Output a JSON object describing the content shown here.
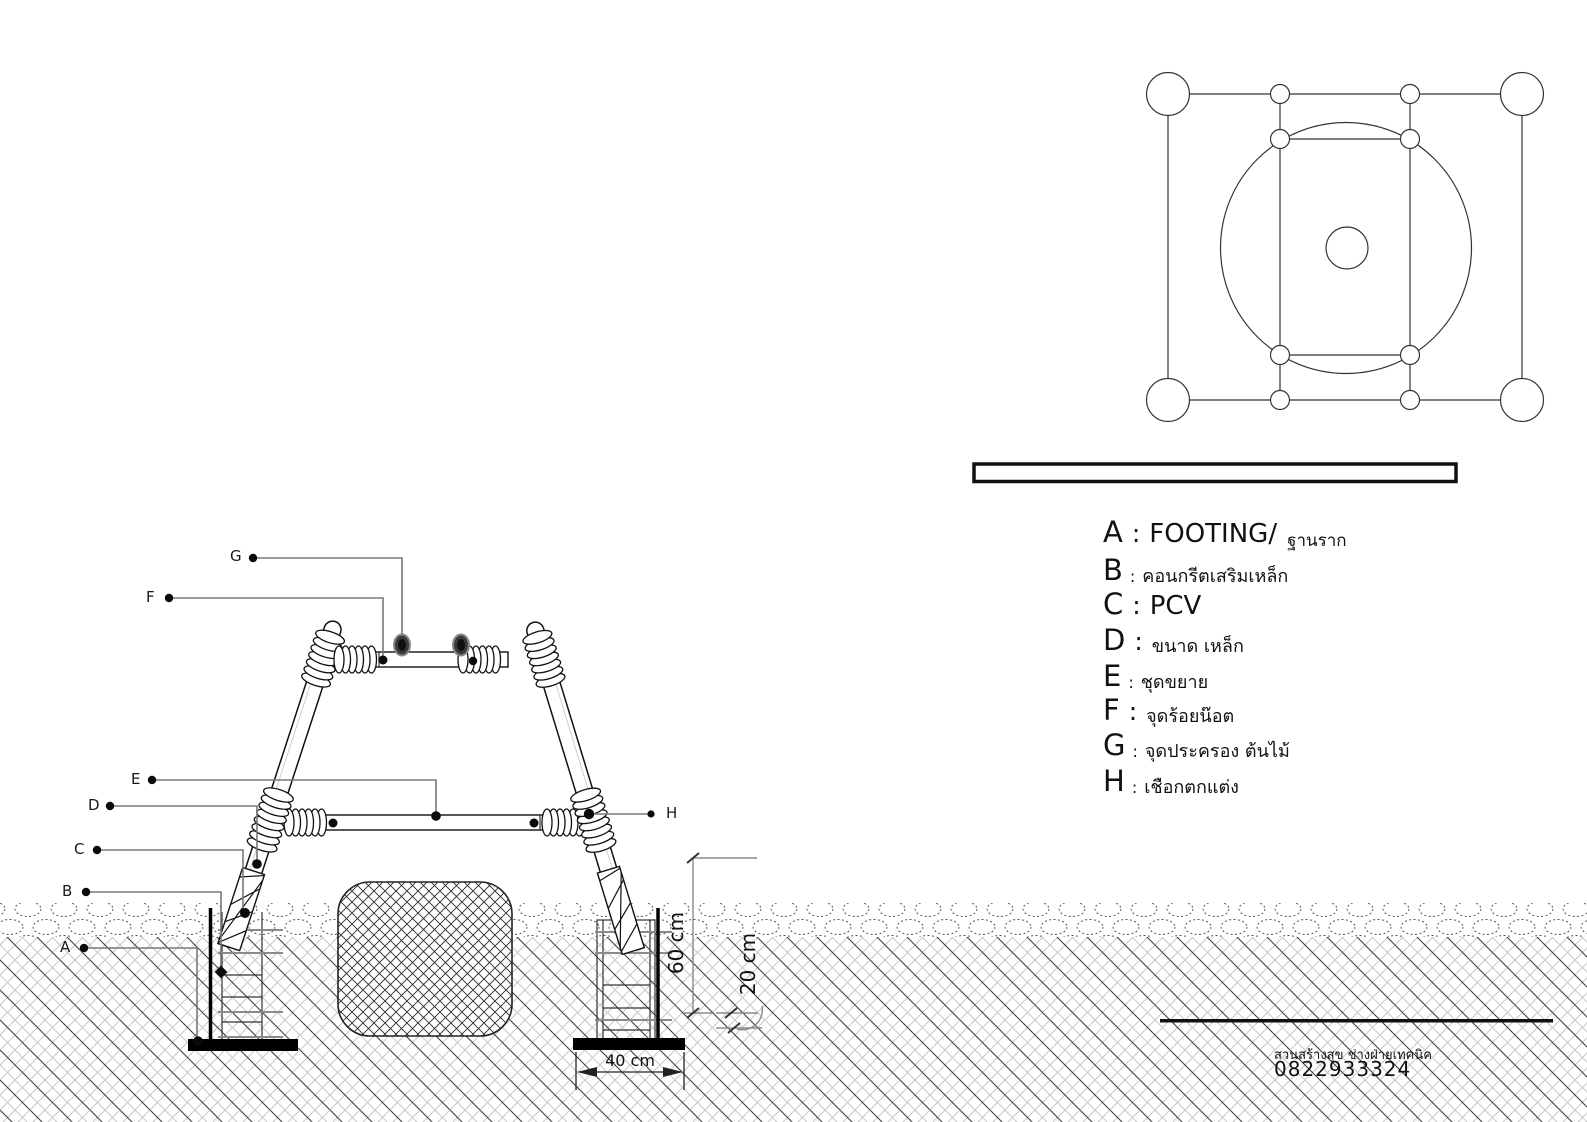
{
  "legend": {
    "items": [
      {
        "letter": "A",
        "sep": ":",
        "label": "FOOTING/",
        "suffix": "ฐานราก"
      },
      {
        "letter": "B",
        "sep": ":",
        "label": "คอนกรีตเสริมเหล็ก",
        "suffix": ""
      },
      {
        "letter": "C",
        "sep": ":",
        "label": "PCV",
        "suffix": ""
      },
      {
        "letter": "D",
        "sep": ":",
        "label": "ขนาด เหล็ก",
        "suffix": ""
      },
      {
        "letter": "E",
        "sep": ":",
        "label": "ชุดขยาย",
        "suffix": ""
      },
      {
        "letter": "F",
        "sep": ":",
        "label": "จุดร้อยน๊อต",
        "suffix": ""
      },
      {
        "letter": "G",
        "sep": ":",
        "label": "จุดประครอง ต้นไม้",
        "suffix": ""
      },
      {
        "letter": "H",
        "sep": ":",
        "label": "เชือกตกแต่ง",
        "suffix": ""
      }
    ]
  },
  "markers": {
    "a": "A",
    "b": "B",
    "c": "C",
    "d": "D",
    "e": "E",
    "f": "F",
    "g": "G",
    "h": "H"
  },
  "dimensions": {
    "depth": "60 cm",
    "offset": "20 cm",
    "width": "40 cm"
  },
  "footer": {
    "company": "สวนสร้างสุข ช่างฝ่ายเทคนิค",
    "phone": "0822933324"
  },
  "colors": {
    "line": "#1a1a1a",
    "leader": "#787878",
    "hatch_light": "#c9c9c9",
    "hatch_dark": "#3f3f3f",
    "knob": "#3c3c3c"
  }
}
